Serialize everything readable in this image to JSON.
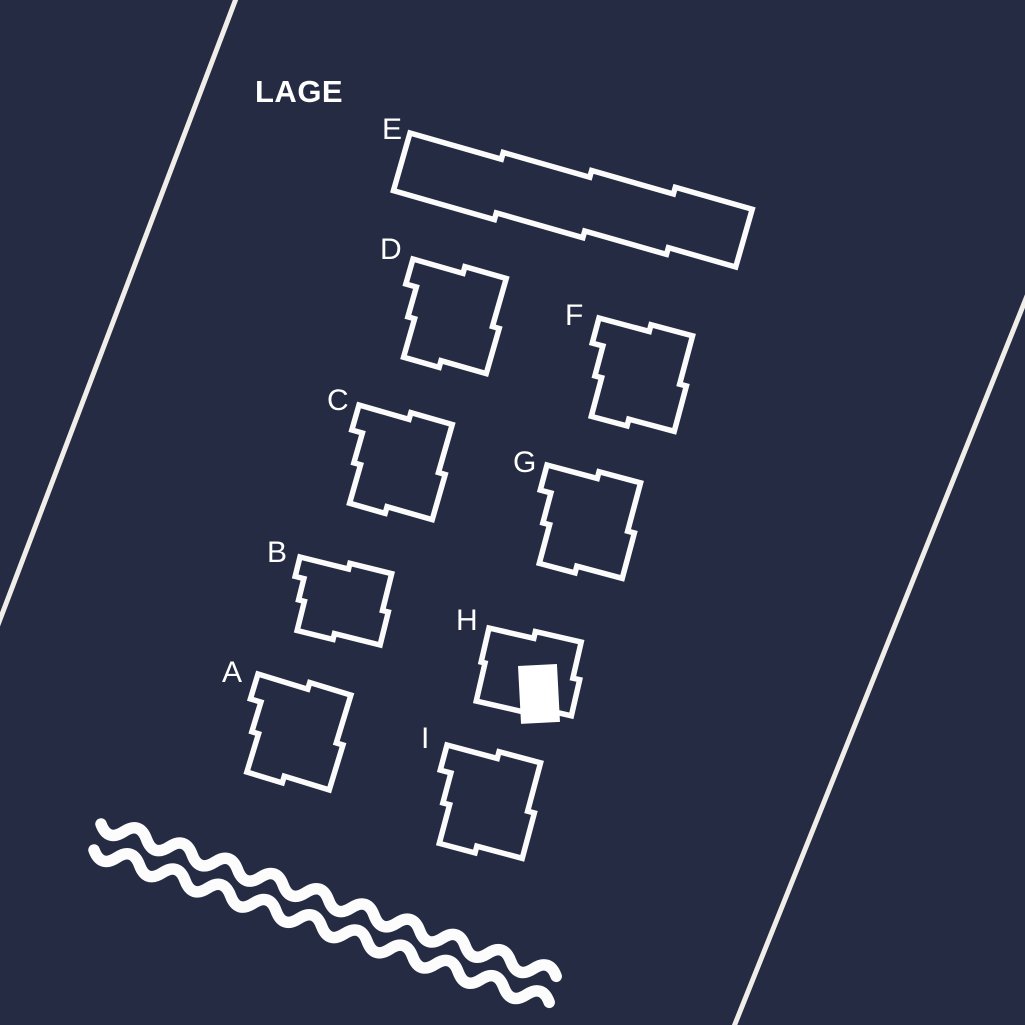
{
  "header": {
    "title": "LAGE"
  },
  "map": {
    "type": "site-plan",
    "buildings": [
      {
        "label": "A"
      },
      {
        "label": "B"
      },
      {
        "label": "C"
      },
      {
        "label": "D"
      },
      {
        "label": "E"
      },
      {
        "label": "F"
      },
      {
        "label": "G"
      },
      {
        "label": "H"
      },
      {
        "label": "I"
      }
    ],
    "highlighted_unit": {
      "building": "H",
      "fill": "#ffffff"
    },
    "features": {
      "water_wave_lines": 2,
      "boundary_lines": 2
    }
  },
  "colors": {
    "background": "#242b42",
    "building_outline": "#fbfbfc",
    "boundary_line": "#f1ede8",
    "wave": "#fcfcfc",
    "label_text": "#ffffff",
    "highlight": "#ffffff"
  }
}
